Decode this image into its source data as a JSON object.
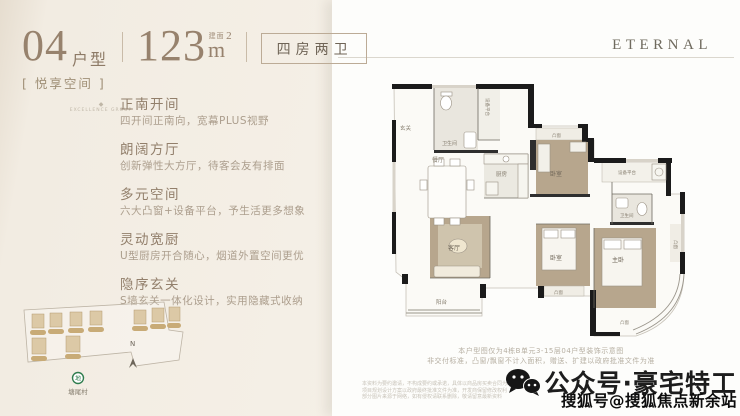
{
  "header": {
    "unit_number": "04",
    "unit_label": "户型",
    "area_value": "123",
    "area_prefix": "建面",
    "area_unit": "m",
    "area_sup": "2",
    "room_tag": "四房两卫",
    "space_tag": "[ 悦享空间 ]",
    "brand": "ETERNAL",
    "group_watermark": "EXCELLENCE GROUP",
    "group_watermark_icon": "◆"
  },
  "features": [
    {
      "title": "正南开间",
      "desc": "四开间正南向，宽幕PLUS视野"
    },
    {
      "title": "朗阔方厅",
      "desc": "创新弹性大方厅，待客会友有排面"
    },
    {
      "title": "多元空间",
      "desc": "六大凸窗+设备平台，予生活更多想象"
    },
    {
      "title": "灵动宽厨",
      "desc": "U型厨房开合随心，烟道外置空间更优"
    },
    {
      "title": "隐序玄关",
      "desc": "S墙玄关一体化设计，实用隐藏式收纳"
    }
  ],
  "floorplan": {
    "labels": {
      "entry": "玄关",
      "bath1": "卫生间",
      "equip1": "设备平台",
      "dining": "餐厅",
      "kitchen": "厨房",
      "bed2": "卧室",
      "bay_top": "凸窗",
      "equip2": "设备平台",
      "bath2": "卫生间",
      "master": "主卧",
      "bed3": "卧室",
      "living": "客厅",
      "balcony": "阳台",
      "bay_bottom": "凸窗",
      "bay_right": "凸窗",
      "bay_curve": "凸窗"
    },
    "caption_line1": "本户型图仅为4栋B单元3-15层04户型装饰示意图",
    "caption_line2": "非交付标准，凸窗/飘窗不计入面积，赠送、扩建以政府批准文件为准"
  },
  "sitemap": {
    "station": "塘尾村",
    "compass": "N"
  },
  "fine_print": {
    "line1": "本资料为要约邀请，不构成要约或承诺，具体以商品房买卖合同为准",
    "line2": "项目规划设计方案以政府最终批准文件为准，开发商保留修改权利",
    "line3": "部分图片来源于网络，如有侵权请联系删除，敬请留意最新资料"
  },
  "watermark": {
    "wechat_label": "公众号·豪宅特工",
    "sohu_label": "搜狐号@搜狐焦点新余站"
  },
  "colors": {
    "accent_tan": "#b7a68d",
    "wall": "#1b1b1b",
    "metro_green": "#2f7d4e"
  }
}
